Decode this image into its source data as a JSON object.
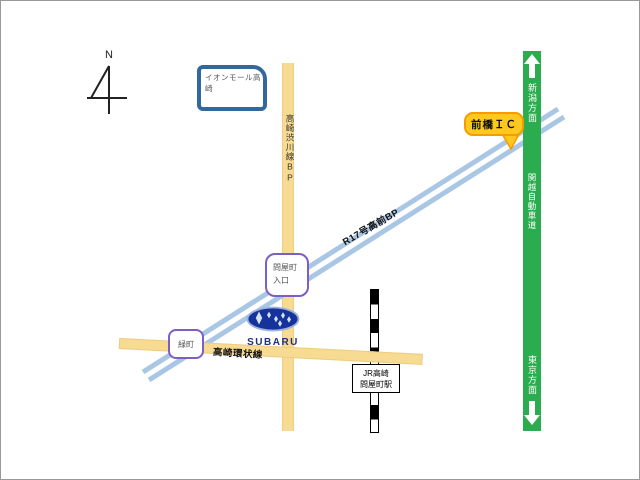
{
  "map": {
    "compass_label": "N",
    "landmarks": {
      "aeon_mall": "イオンモール高崎",
      "subaru_logo_text": "SUBARU",
      "station_line1": "JR高崎",
      "station_line2": "問屋町駅"
    },
    "roads": {
      "shibukawa_bp": "高崎渋川線BP",
      "ring_road": "高崎環状線",
      "r17_bp": "R17号高前BP",
      "kanetsu_expwy": "関越自動車道",
      "dir_niigata": "新潟方面",
      "dir_tokyo": "東京方面"
    },
    "markers": {
      "maebashi_ic": "前橋ＩＣ",
      "tonyamachi_line1": "問屋町",
      "tonyamachi_line2": "入口",
      "midoricho": "緑町"
    },
    "colors": {
      "expressway_green": "#2BAD4F",
      "road_yellow": "#F8DB92",
      "bypass_blue": "#A9C7E5",
      "ic_gold": "#FFC81E",
      "ic_border_orange": "#F49C00",
      "marker_purple": "#7B5EC6",
      "landmark_blue": "#33689E",
      "subaru_navy": "#16339B"
    }
  }
}
